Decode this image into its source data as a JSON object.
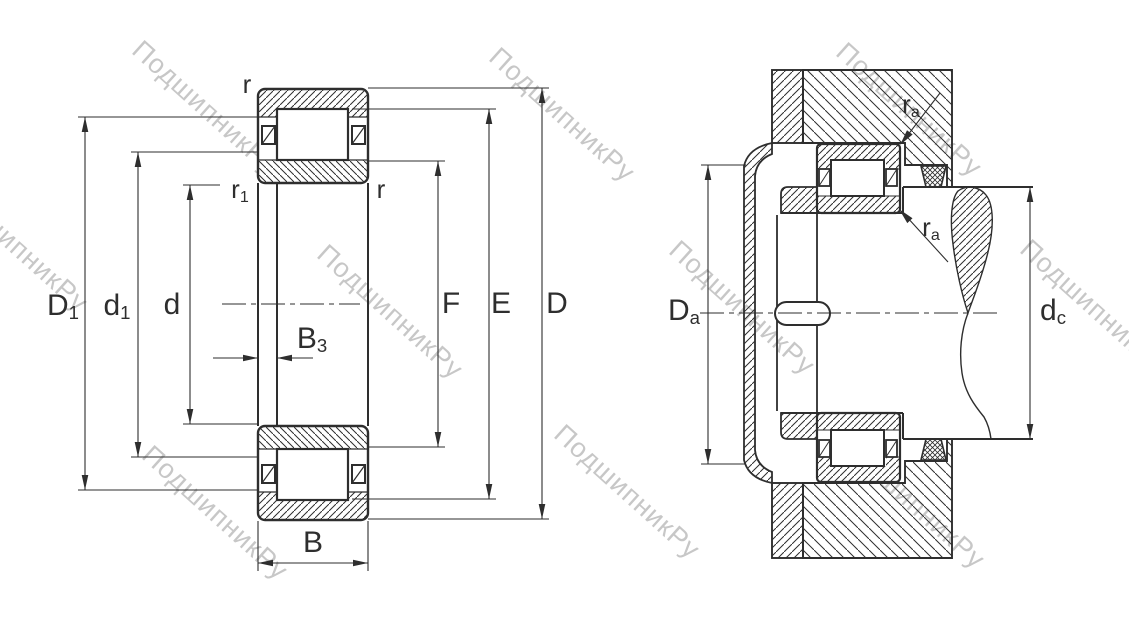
{
  "watermark": {
    "text": "ПодшипникРу",
    "color": "#c7c7c7"
  },
  "colors": {
    "background": "#ffffff",
    "line": "#2e2e2e"
  },
  "left_view": {
    "labels": {
      "r_top": {
        "main": "r",
        "sub": ""
      },
      "r1": {
        "main": "r",
        "sub": "1"
      },
      "r_right": {
        "main": "r",
        "sub": ""
      },
      "D1": {
        "main": "D",
        "sub": "1"
      },
      "d1": {
        "main": "d",
        "sub": "1"
      },
      "d": {
        "main": "d",
        "sub": ""
      },
      "B3": {
        "main": "B",
        "sub": "3"
      },
      "B": {
        "main": "B",
        "sub": ""
      },
      "F": {
        "main": "F",
        "sub": ""
      },
      "E": {
        "main": "E",
        "sub": ""
      },
      "D": {
        "main": "D",
        "sub": ""
      }
    }
  },
  "right_view": {
    "labels": {
      "Da": {
        "main": "D",
        "sub": "a"
      },
      "dc": {
        "main": "d",
        "sub": "c"
      },
      "ra_top": {
        "main": "r",
        "sub": "a"
      },
      "ra_bottom": {
        "main": "r",
        "sub": "a"
      }
    }
  }
}
